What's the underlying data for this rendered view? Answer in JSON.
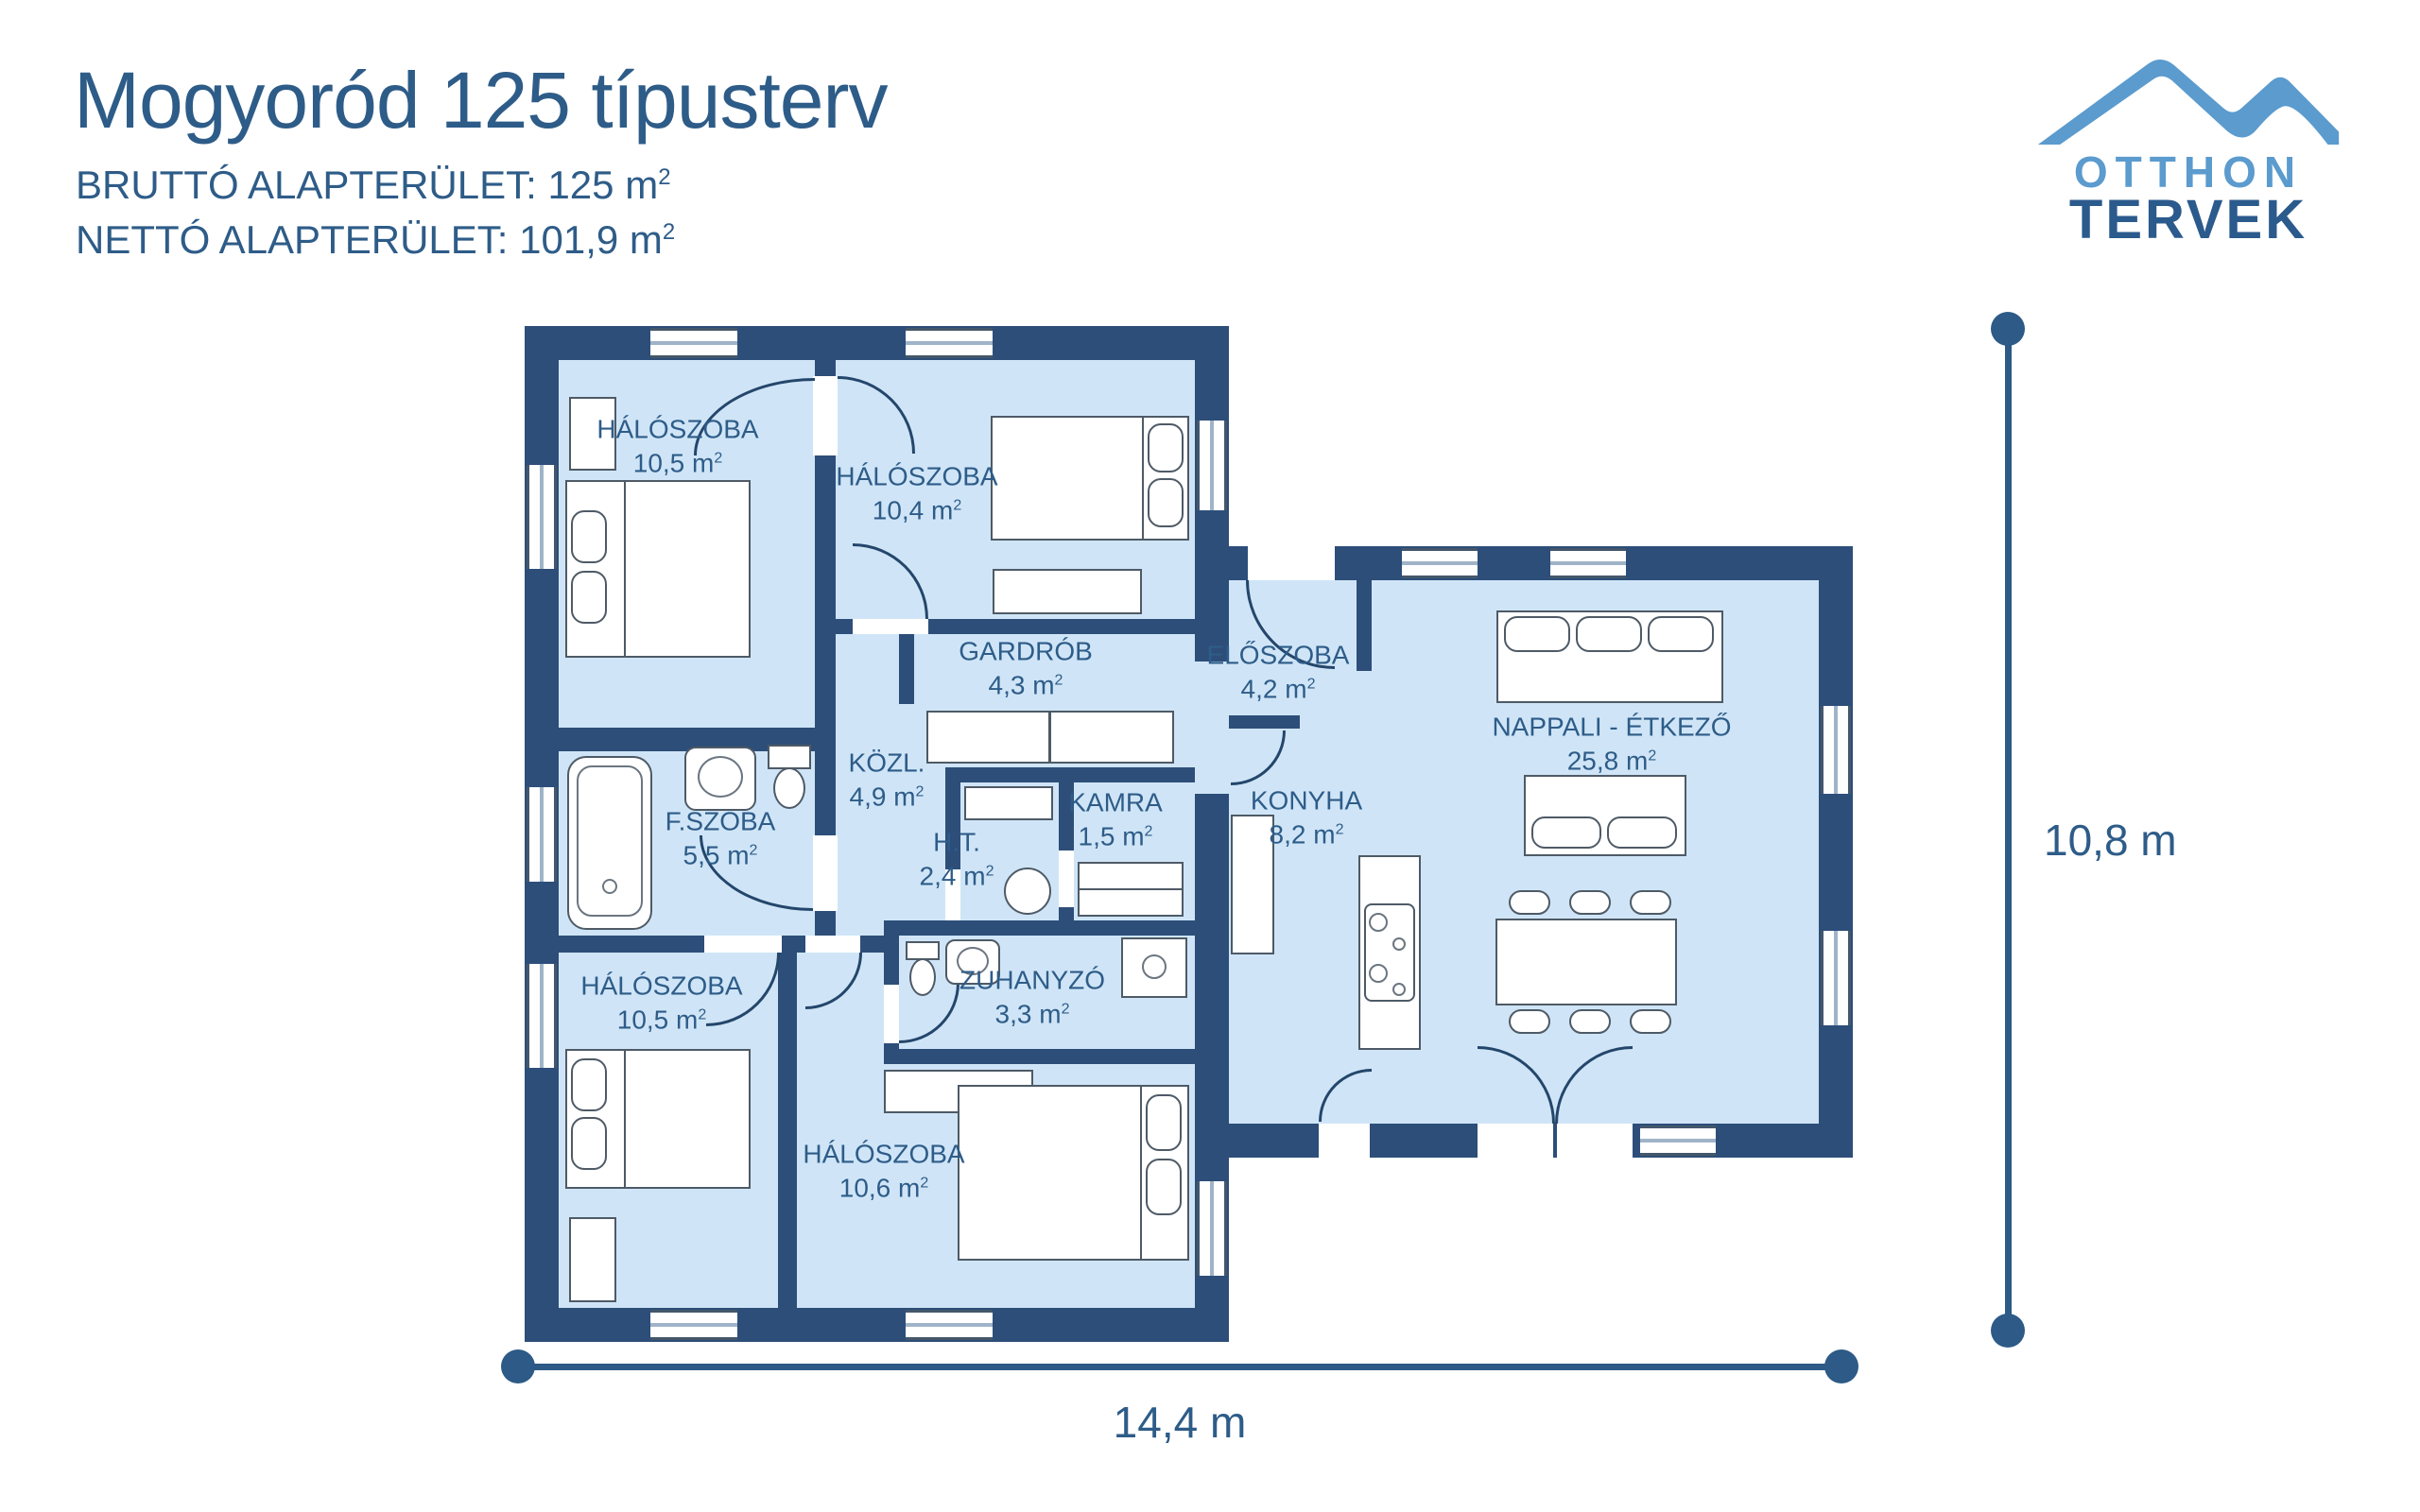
{
  "header": {
    "title": "Mogyoród 125 típusterv",
    "gross": "BRUTTÓ ALAPTERÜLET: 125 m",
    "net": "NETTÓ ALAPTERÜLET: 101,9 m",
    "sup": "2"
  },
  "logo": {
    "line1": "OTTHON",
    "line2": "TERVEK"
  },
  "rooms": [
    {
      "name": "HÁLÓSZOBA",
      "area": "10,5 m",
      "sup": "2"
    },
    {
      "name": "HÁLÓSZOBA",
      "area": "10,4 m",
      "sup": "2"
    },
    {
      "name": "GARDRÓB",
      "area": "4,3 m",
      "sup": "2"
    },
    {
      "name": "ELŐSZOBA",
      "area": "4,2 m",
      "sup": "2"
    },
    {
      "name": "NAPPALI - ÉTKEZŐ",
      "area": "25,8 m",
      "sup": "2"
    },
    {
      "name": "KÖZL.",
      "area": "4,9 m",
      "sup": "2"
    },
    {
      "name": "F.SZOBA",
      "area": "5,5 m",
      "sup": "2"
    },
    {
      "name": "KAMRA",
      "area": "1,5 m",
      "sup": "2"
    },
    {
      "name": "H.T.",
      "area": "2,4 m",
      "sup": "2"
    },
    {
      "name": "KONYHA",
      "area": "8,2 m",
      "sup": "2"
    },
    {
      "name": "HÁLÓSZOBA",
      "area": "10,5 m",
      "sup": "2"
    },
    {
      "name": "ZUHANYZÓ",
      "area": "3,3 m",
      "sup": "2"
    },
    {
      "name": "HÁLÓSZOBA",
      "area": "10,6 m",
      "sup": "2"
    }
  ],
  "dimensions": {
    "width": "14,4 m",
    "height": "10,8 m"
  },
  "colors": {
    "wall": "#2d4e79",
    "floor": "#cfe5f7",
    "text": "#2e5c88",
    "logo_light": "#5b9bce",
    "logo_dark": "#2b5a8c"
  }
}
